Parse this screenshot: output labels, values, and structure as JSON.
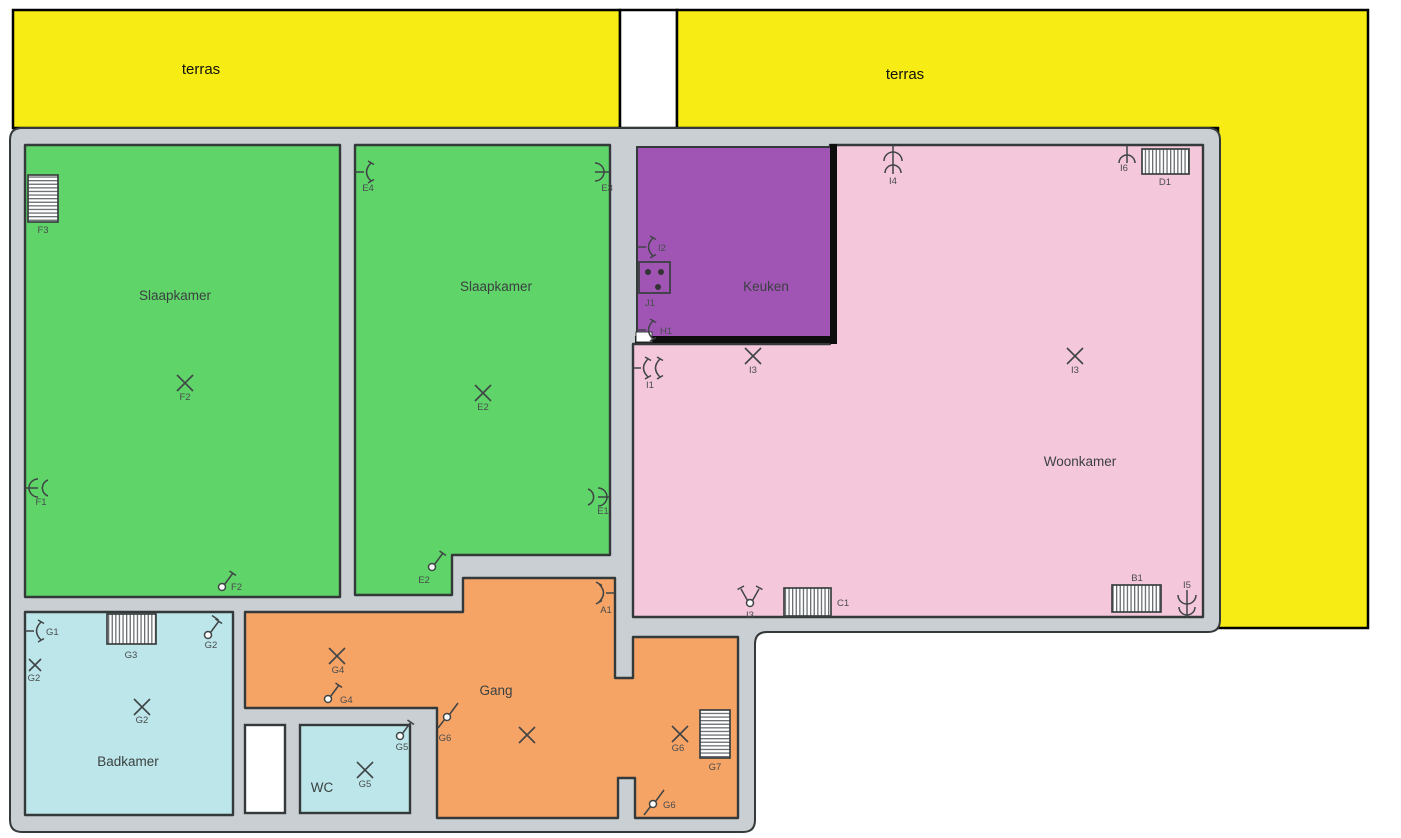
{
  "title": "Floor plan with electrical installation symbols",
  "terrace_left": {
    "label": "terras"
  },
  "terrace_right": {
    "label": "terras"
  },
  "rooms": {
    "slaapkamer1": "Slaapkamer",
    "slaapkamer2": "Slaapkamer",
    "keuken": "Keuken",
    "woonkamer": "Woonkamer",
    "badkamer": "Badkamer",
    "gang": "Gang",
    "wc": "WC"
  },
  "symbols": {
    "f3": "F3",
    "f2c": "F2",
    "f1": "F1",
    "f2s": "F2",
    "e4": "E4",
    "e3": "E3",
    "e2c": "E2",
    "e1": "E1",
    "e2s": "E2",
    "i2": "I2",
    "j1": "J1",
    "h1": "H1",
    "i4": "I4",
    "i6": "I6",
    "d1": "D1",
    "i1": "I1",
    "i3a": "I3",
    "i3b": "I3",
    "i3s": "I3",
    "c1": "C1",
    "b1": "B1",
    "i5": "I5",
    "a1": "A1",
    "g4c": "G4",
    "g4s": "G4",
    "g6s1": "G6",
    "g6c": "G6",
    "g7": "G7",
    "g6s2": "G6",
    "g5s": "G5",
    "g5c": "G5",
    "g1": "G1",
    "g2a": "G2",
    "g3": "G3",
    "g2b": "G2",
    "g2c": "G2"
  },
  "colors": {
    "terrace": "#F7EC13",
    "bedroom": "#5FD469",
    "kitchen": "#A055B5",
    "living": "#F5C7DA",
    "hall": "#F6A366",
    "bath": "#BDE6EA",
    "wall": "#CACFD3",
    "outline": "#34393A",
    "kitchen_border": "#0D0D0D"
  }
}
